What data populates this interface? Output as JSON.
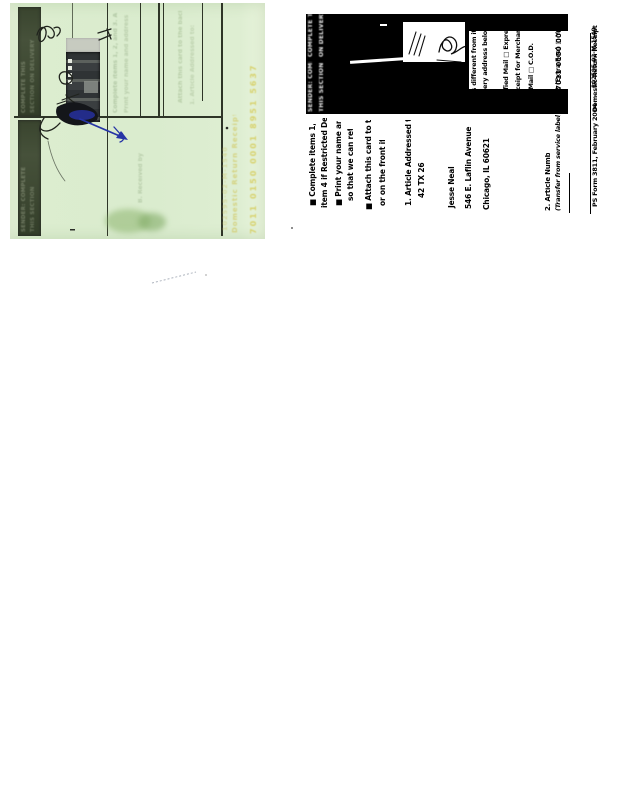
{
  "green_card": {
    "bar_top_lines": [
      "COMPLETE THIS",
      "SECTION ON DELIVERY"
    ],
    "bar_bottom_lines": [
      "SENDER: COMPLETE",
      "THIS SECTION"
    ],
    "ghost_print_1": "Complete items 1, 2, and 3. Also complete item 4",
    "ghost_print_2": "Print your name and address on the reverse",
    "ghost_print_3": "Attach this card to the back of the mailpiece",
    "ghost_print_4": "1. Article Addressed to:",
    "ghost_print_5": "B. Received by",
    "yellow_print_1": "7011 0150 0001 8951 5637",
    "yellow_print_2": "Domestic Return Receipt",
    "yellow_print_3": "102595-02-M-1540",
    "ink_color": "#2634a6"
  },
  "receipt_copy": {
    "header_sender_lines": [
      "SENDER: COMPLETE",
      "THIS SECTION"
    ],
    "header_delivery_lines": [
      "COMPLETE THIS SECTION",
      "ON DELIVERY"
    ],
    "instructions": [
      "■ Complete items 1, 2, and 3. Also complete",
      "item 4 if Restricted Delivery is desired.",
      "■ Print your name and address on the reverse",
      "so that we can return the card to you.",
      "■ Attach this card to the back of the mailpiece,",
      "or on the front if space permits."
    ],
    "article_addressed_label": "1. Article Addressed to:",
    "addressee": [
      "42 TX 26",
      "Jesse Neal",
      "546 E. Laflin Avenue",
      "Chicago, IL 60621"
    ],
    "right_column": {
      "lines": [
        "D. Is delivery address different from item 1?  □ Yes",
        "If YES, enter delivery address below:  □ No",
        "3. Service Type   □ Certified Mail  □ Express Mail",
        "□ Registered   □ Return Receipt for Merchandise",
        "□ Insured Mail   □ C.O.D.",
        "4. Restricted Delivery? (Extra Fee)  □ Yes"
      ]
    },
    "article_number_label": "2. Article Number",
    "transfer_label": "(Transfer from service label)",
    "article_number": "7011 0150 0001 8951 5637",
    "footer_form": "PS Form 3811, February 2004",
    "footer_title": "Domestic Return Receipt",
    "footer_code": "102595-02-M-1540"
  }
}
